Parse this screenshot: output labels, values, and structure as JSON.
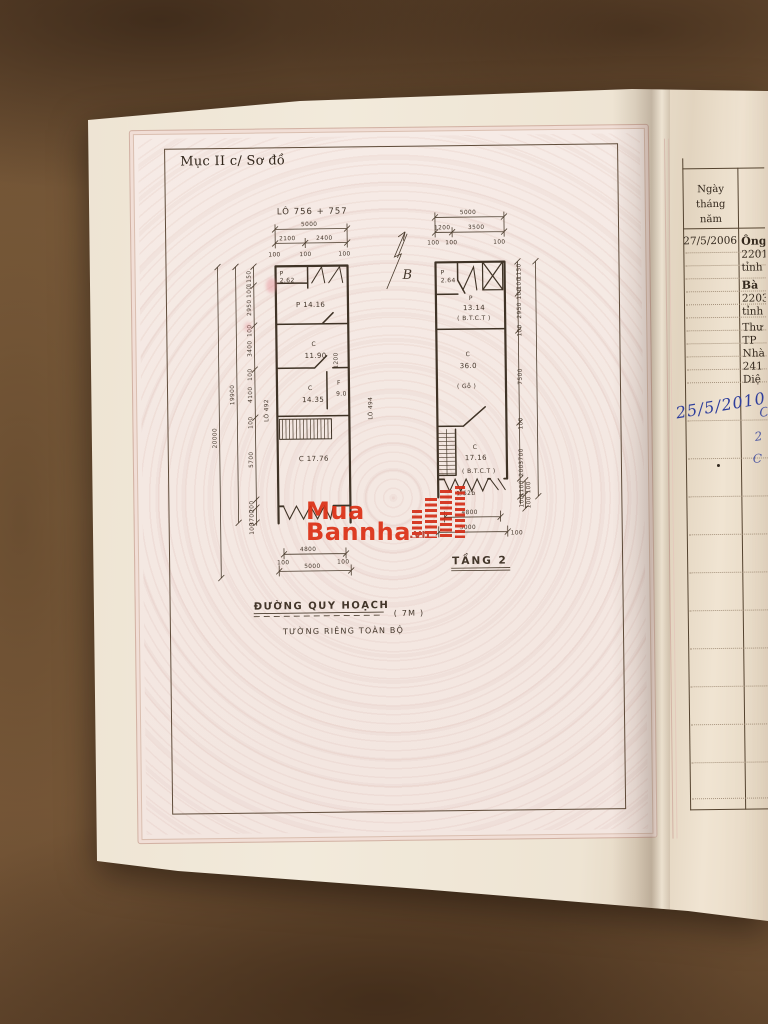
{
  "plan_page": {
    "section_title": "Mục II c/ Sơ đồ",
    "lot_title": "LÔ 756 + 757",
    "north_label": "B",
    "lot_left": "LÔ 492",
    "lot_right": "LÔ 494",
    "street_name": "ĐƯỜNG QUY HOẠCH",
    "street_width": "( 7M )",
    "street_note": "TƯỜNG RIÊNG TOÀN BỘ",
    "floor2_label": "TẦNG 2",
    "dims": {
      "d100": "100",
      "d200": "200",
      "d1100": "1100",
      "d1150": "1150",
      "d1200": "1200",
      "d2100": "2100",
      "d2400": "2400",
      "d2950": "2950",
      "d3400": "3400",
      "d3500": "3500",
      "d3700": "3700",
      "d4100": "4100",
      "d4800": "4800",
      "d5000": "5000",
      "d5700": "5700",
      "d7500": "7500",
      "d19900": "19900",
      "d20000": "20000"
    },
    "rooms1": {
      "r1_code": "P",
      "r1_area": "2.62",
      "r2": "P 14.16",
      "r3_code": "C",
      "r3_area": "11.90",
      "r4_code": "C",
      "r4_area": "14.35",
      "r5_code": "F",
      "r5_area": "9.0",
      "r6": "C 17.76"
    },
    "rooms2": {
      "r1_code": "P",
      "r1_area": "2.64",
      "r2_code": "P",
      "r2_area": "13.14",
      "r2_note": "( B.T.C.T )",
      "r3_code": "C",
      "r3_area": "36.0",
      "r3_note": "( Gỗ )",
      "r4_code": "C",
      "r4_area": "17.16",
      "r4_note": "( B.T.C.T )",
      "stair_note": "1/52b"
    }
  },
  "record_page": {
    "col_header_line1": "Ngày tháng",
    "col_header_line2": "năm",
    "printed_date": "27/5/2006",
    "entries": [
      "Ông",
      "2201",
      "tỉnh",
      "Bà",
      "2203",
      "tỉnh",
      "Thư",
      "TP",
      "Nhà",
      "241",
      "Diệ"
    ],
    "handwritten_date": "25/5/2010",
    "handwritten_fragments": [
      "C",
      "2",
      "C"
    ]
  },
  "watermark": {
    "line1": "Mua",
    "line2": "Bannha",
    "suffix": ".vn"
  },
  "colors": {
    "watermark_red": "#dc3015",
    "ink_blue": "#2e3e9c",
    "paper_pink": "#f5e9e4",
    "fabric_brown": "#7f5f3d"
  }
}
